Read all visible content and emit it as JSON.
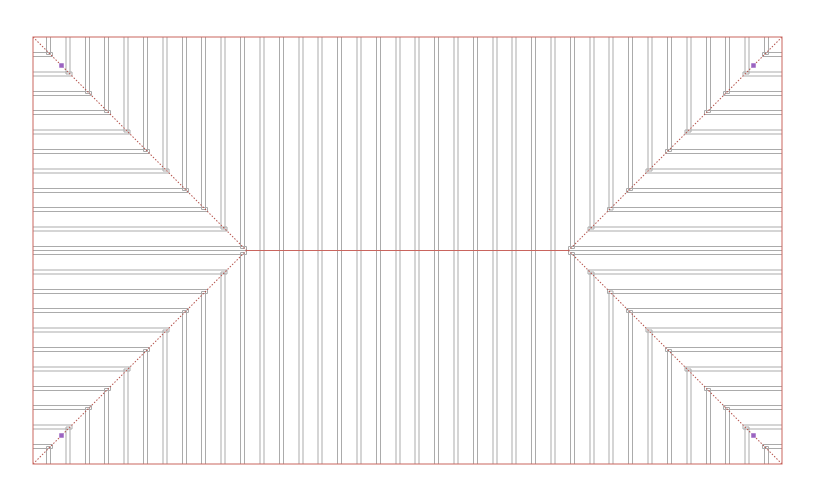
{
  "window": {
    "width": 817,
    "height": 498,
    "background": "#ffffff"
  },
  "colors": {
    "outline_red": "#c9655e",
    "ridge_red": "#c9655e",
    "hip_red": "#b5534c",
    "rafter_gray": "#ababab",
    "grip_purple": "#9b63c1",
    "background": "#ffffff"
  },
  "drawing": {
    "outline": {
      "x0": 33,
      "y0": 37,
      "x1": 782,
      "y1": 464
    },
    "ridge": {
      "y": 250.5,
      "x_start": 246.5,
      "x_end": 568.5
    },
    "apexes": [
      {
        "x": 246.5,
        "y": 250.5
      },
      {
        "x": 568.5,
        "y": 250.5
      }
    ],
    "hips": [
      [
        33,
        37,
        246.5,
        250.5
      ],
      [
        33,
        464,
        246.5,
        250.5
      ],
      [
        782,
        37,
        568.5,
        250.5
      ],
      [
        782,
        464,
        568.5,
        250.5
      ]
    ],
    "rafters": {
      "spacing": 19.405,
      "thickness": 4,
      "vertical_first_x": 46.5,
      "vertical_count": 38,
      "horizontal_rows_per_side": 11
    },
    "grips": {
      "size": 4.5,
      "points": [
        [
          61.5,
          65.5
        ],
        [
          753.5,
          65.5
        ],
        [
          753.5,
          435.5
        ],
        [
          61.5,
          435.5
        ]
      ]
    }
  }
}
